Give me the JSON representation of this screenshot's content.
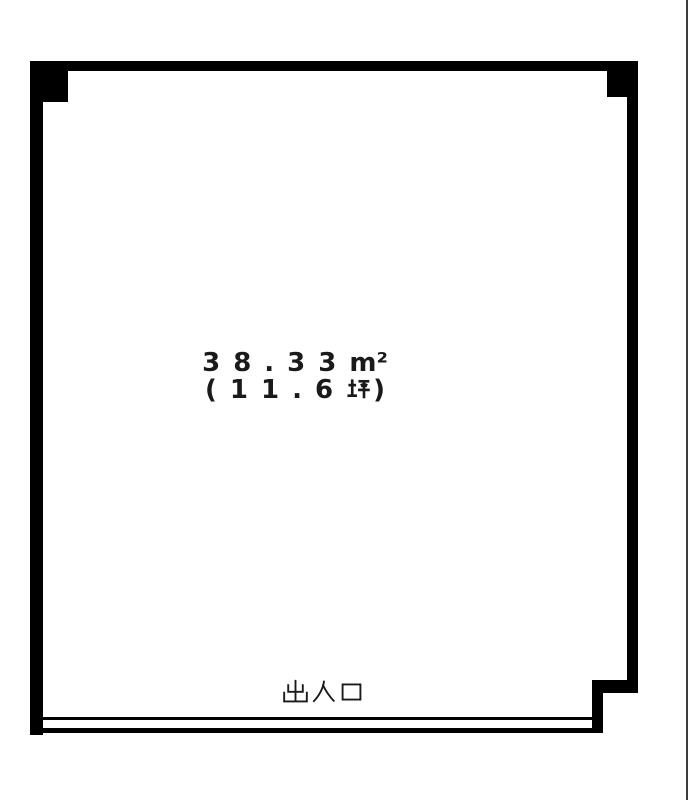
{
  "page": {
    "background_color": "#ffffff",
    "right_edge_line_color": "#3c3c3c"
  },
  "floorplan": {
    "wall_color": "#000000",
    "text_color": "#1a1a1a",
    "room": {
      "area_label": "38.33㎡",
      "area_tsubo_label": "(11.6坪)",
      "display": {
        "area_value": "38.33",
        "area_unit": "m²",
        "tsubo_prefix": "(11.6",
        "tsubo_unit": "坪",
        "tsubo_suffix": ")"
      }
    },
    "entrance": {
      "label": "出入口"
    }
  }
}
